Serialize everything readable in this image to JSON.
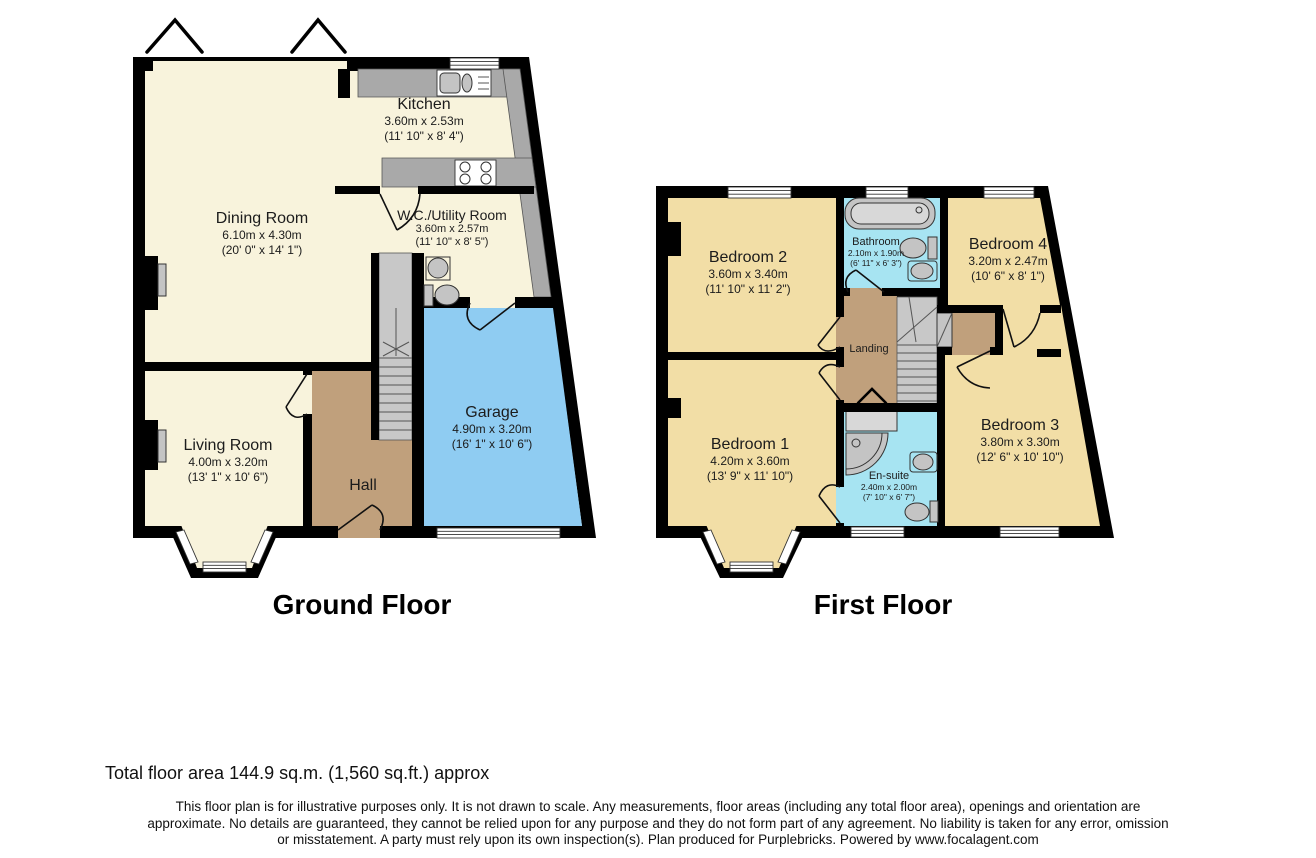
{
  "ground_floor": {
    "title": "Ground Floor",
    "rooms": {
      "kitchen": {
        "name": "Kitchen",
        "dim_m": "3.60m x 2.53m",
        "dim_ft": "(11' 10\" x 8' 4\")"
      },
      "dining_room": {
        "name": "Dining Room",
        "dim_m": "6.10m x 4.30m",
        "dim_ft": "(20' 0\" x 14' 1\")"
      },
      "wc_utility": {
        "name": "W.C./Utility Room",
        "dim_m": "3.60m x 2.57m",
        "dim_ft": "(11' 10\" x 8' 5\")"
      },
      "garage": {
        "name": "Garage",
        "dim_m": "4.90m x 3.20m",
        "dim_ft": "(16' 1\" x 10' 6\")"
      },
      "living_room": {
        "name": "Living Room",
        "dim_m": "4.00m x 3.20m",
        "dim_ft": "(13' 1\" x 10' 6\")"
      },
      "hall": {
        "name": "Hall"
      }
    }
  },
  "first_floor": {
    "title": "First Floor",
    "rooms": {
      "bedroom2": {
        "name": "Bedroom 2",
        "dim_m": "3.60m x 3.40m",
        "dim_ft": "(11' 10\" x 11' 2\")"
      },
      "bathroom": {
        "name": "Bathroom",
        "dim_m": "2.10m x 1.90m",
        "dim_ft": "(6' 11\" x 6' 3\")"
      },
      "bedroom4": {
        "name": "Bedroom 4",
        "dim_m": "3.20m x 2.47m",
        "dim_ft": "(10' 6\" x 8' 1\")"
      },
      "landing": {
        "name": "Landing"
      },
      "bedroom1": {
        "name": "Bedroom 1",
        "dim_m": "4.20m x 3.60m",
        "dim_ft": "(13' 9\" x 11' 10\")"
      },
      "ensuite": {
        "name": "En-suite",
        "dim_m": "2.40m x 2.00m",
        "dim_ft": "(7' 10\" x 6' 7\")"
      },
      "bedroom3": {
        "name": "Bedroom 3",
        "dim_m": "3.80m x 3.30m",
        "dim_ft": "(12' 6\" x 10' 10\")"
      }
    }
  },
  "footer": {
    "total_area": "Total floor area 144.9 sq.m. (1,560 sq.ft.) approx",
    "disclaimer_lines": [
      "This floor plan is for illustrative purposes only. It is not drawn to scale. Any measurements, floor areas (including any total floor area), openings and orientation are",
      "approximate. No details are guaranteed, they cannot be relied upon for any purpose and they do not form part of any agreement. No liability is taken for any error, omission",
      "or misstatement. A party must rely upon its own inspection(s). Plan produced for Purplebricks. Powered by www.focalagent.com"
    ]
  },
  "colors": {
    "wall": "#000000",
    "cream": "#F8F3DC",
    "tan": "#F2DEA6",
    "cyan": "#A7E4F2",
    "blue": "#8FCCF2",
    "brown": "#C0A07C",
    "counter": "#A9A9A9",
    "stairs": "#C8C8C8",
    "fixture": "#C4C4C4"
  }
}
